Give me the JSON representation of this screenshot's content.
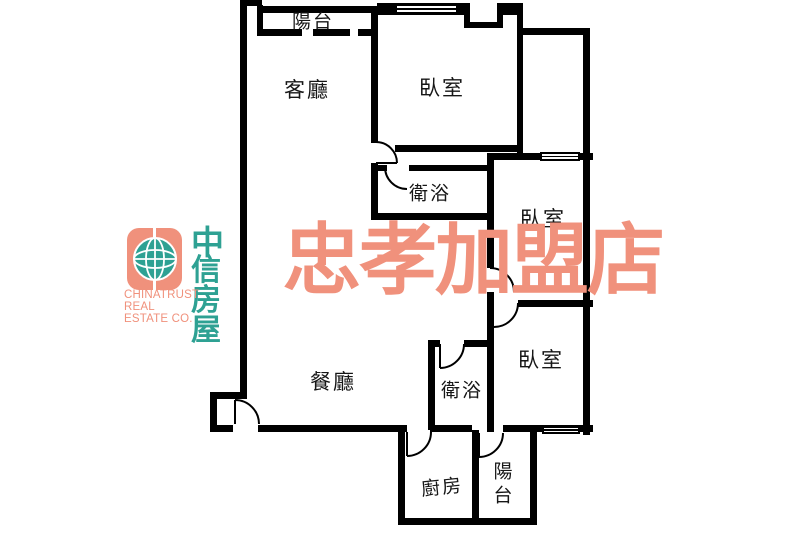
{
  "plan": {
    "rooms": {
      "balcony_top": "陽台",
      "living": "客廳",
      "bedroom_top": "臥室",
      "bath_top": "衛浴",
      "bedroom_mid": "臥室",
      "dining": "餐廳",
      "bath_low": "衛浴",
      "bedroom_low": "臥室",
      "kitchen": "廚房",
      "balcony_bottom": "陽台"
    }
  },
  "branding": {
    "logo": {
      "cjk_line1": "中",
      "cjk_line2": "信房屋",
      "subtitle": "CHINATRUST REAL ESTATE CO.",
      "globe_icon": "globe-icon"
    },
    "watermark": "忠孝加盟店",
    "colors": {
      "salmon": "#f0917c",
      "teal": "#2ea193",
      "line": "#000000"
    }
  }
}
